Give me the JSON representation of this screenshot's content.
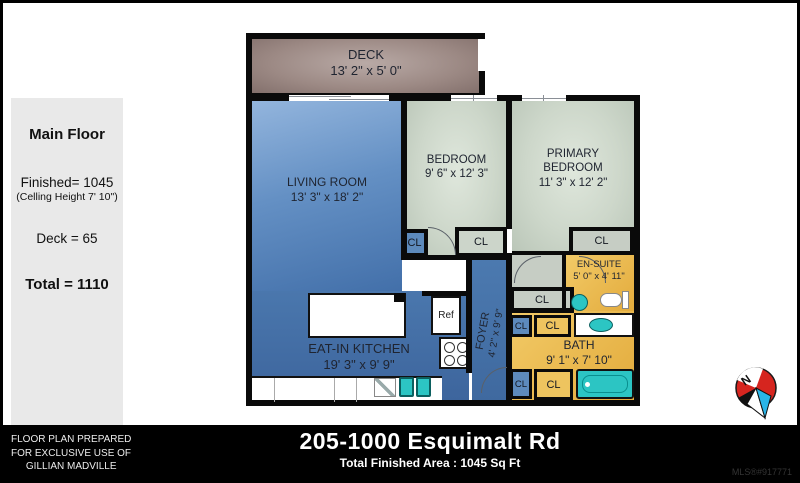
{
  "sidebar": {
    "title": "Main Floor",
    "finished": "Finished= 1045",
    "ceiling": "(Celling Height 7' 10\")",
    "deck_area": "Deck = 65",
    "total": "Total = 1110"
  },
  "rooms": {
    "deck": {
      "name": "DECK",
      "dims": "13' 2\" x 5' 0\""
    },
    "living": {
      "name": "LIVING ROOM",
      "dims": "13' 3\" x 18' 2\""
    },
    "bedroom": {
      "name": "BEDROOM",
      "dims": "9' 6\" x 12' 3\""
    },
    "primary": {
      "name_line1": "PRIMARY",
      "name_line2": "BEDROOM",
      "dims": "11' 3\" x 12' 2\""
    },
    "ensuite": {
      "name": "EN-SUITE",
      "dims": "5' 0\" x 4' 11\""
    },
    "bath": {
      "name": "BATH",
      "dims": "9' 1\" x 7' 10\""
    },
    "kitchen": {
      "name": "EAT-IN KITCHEN",
      "dims": "19' 3\" x 9' 9\""
    },
    "foyer": {
      "name": "FOYER",
      "dims": "4' 2\" x 9' 9\""
    }
  },
  "labels": {
    "closet": "CL",
    "fridge": "Ref",
    "north": "N"
  },
  "footer": {
    "prepared_line1": "FLOOR PLAN PREPARED",
    "prepared_line2": "FOR EXCLUSIVE USE OF",
    "prepared_line3": "GILLIAN MADVILLE",
    "address": "205-1000 Esquimalt Rd",
    "area": "Total Finished Area : 1045 Sq Ft",
    "mls": "MLS®#917771"
  },
  "colors": {
    "wall": "#0a0a0a",
    "living_blue": "#4a77ad",
    "bedroom_green": "#ccd6c9",
    "bath_yellow": "#e8b84e",
    "closet_blue": "#5d8abc",
    "fixture_teal": "#2cc5c3",
    "deck_brown": "#9c8984",
    "compass_red": "#d6251f",
    "footer_bg": "#000000"
  }
}
